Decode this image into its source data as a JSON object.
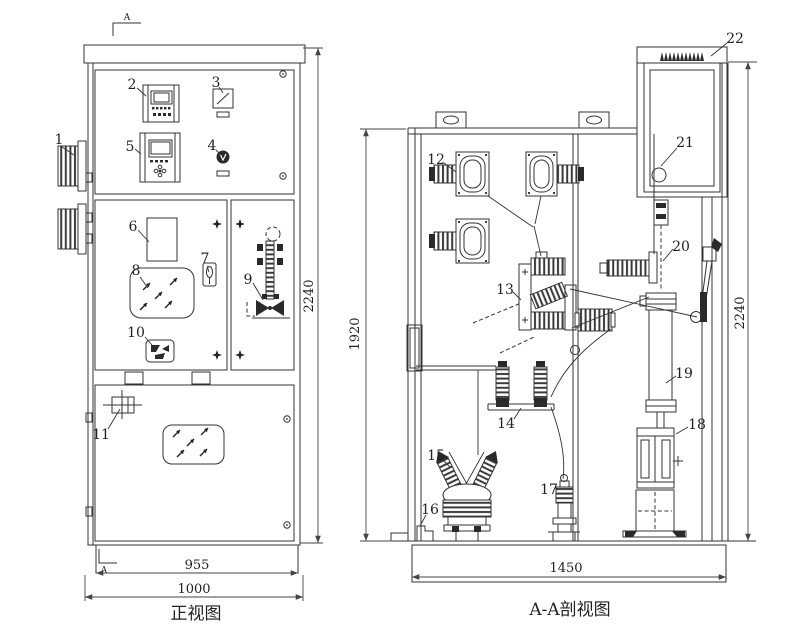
{
  "front": {
    "title": "正视图",
    "marker_top": "A",
    "marker_bottom": "A",
    "dim_height": "2240",
    "dim_width_door": "955",
    "dim_width_overall": "1000",
    "callouts": {
      "c1": "1",
      "c2": "2",
      "c3": "3",
      "c4": "4",
      "c5": "5",
      "c6": "6",
      "c7": "7",
      "c8": "8",
      "c9": "9",
      "c10": "10",
      "c11": "11"
    }
  },
  "section": {
    "title": "A-A剖视图",
    "dim_height_inner": "1920",
    "dim_height": "2240",
    "dim_width": "1450",
    "callouts": {
      "c12": "12",
      "c13": "13",
      "c14": "14",
      "c15": "15",
      "c16": "16",
      "c17": "17",
      "c18": "18",
      "c19": "19",
      "c20": "20",
      "c21": "21",
      "c22": "22"
    }
  }
}
